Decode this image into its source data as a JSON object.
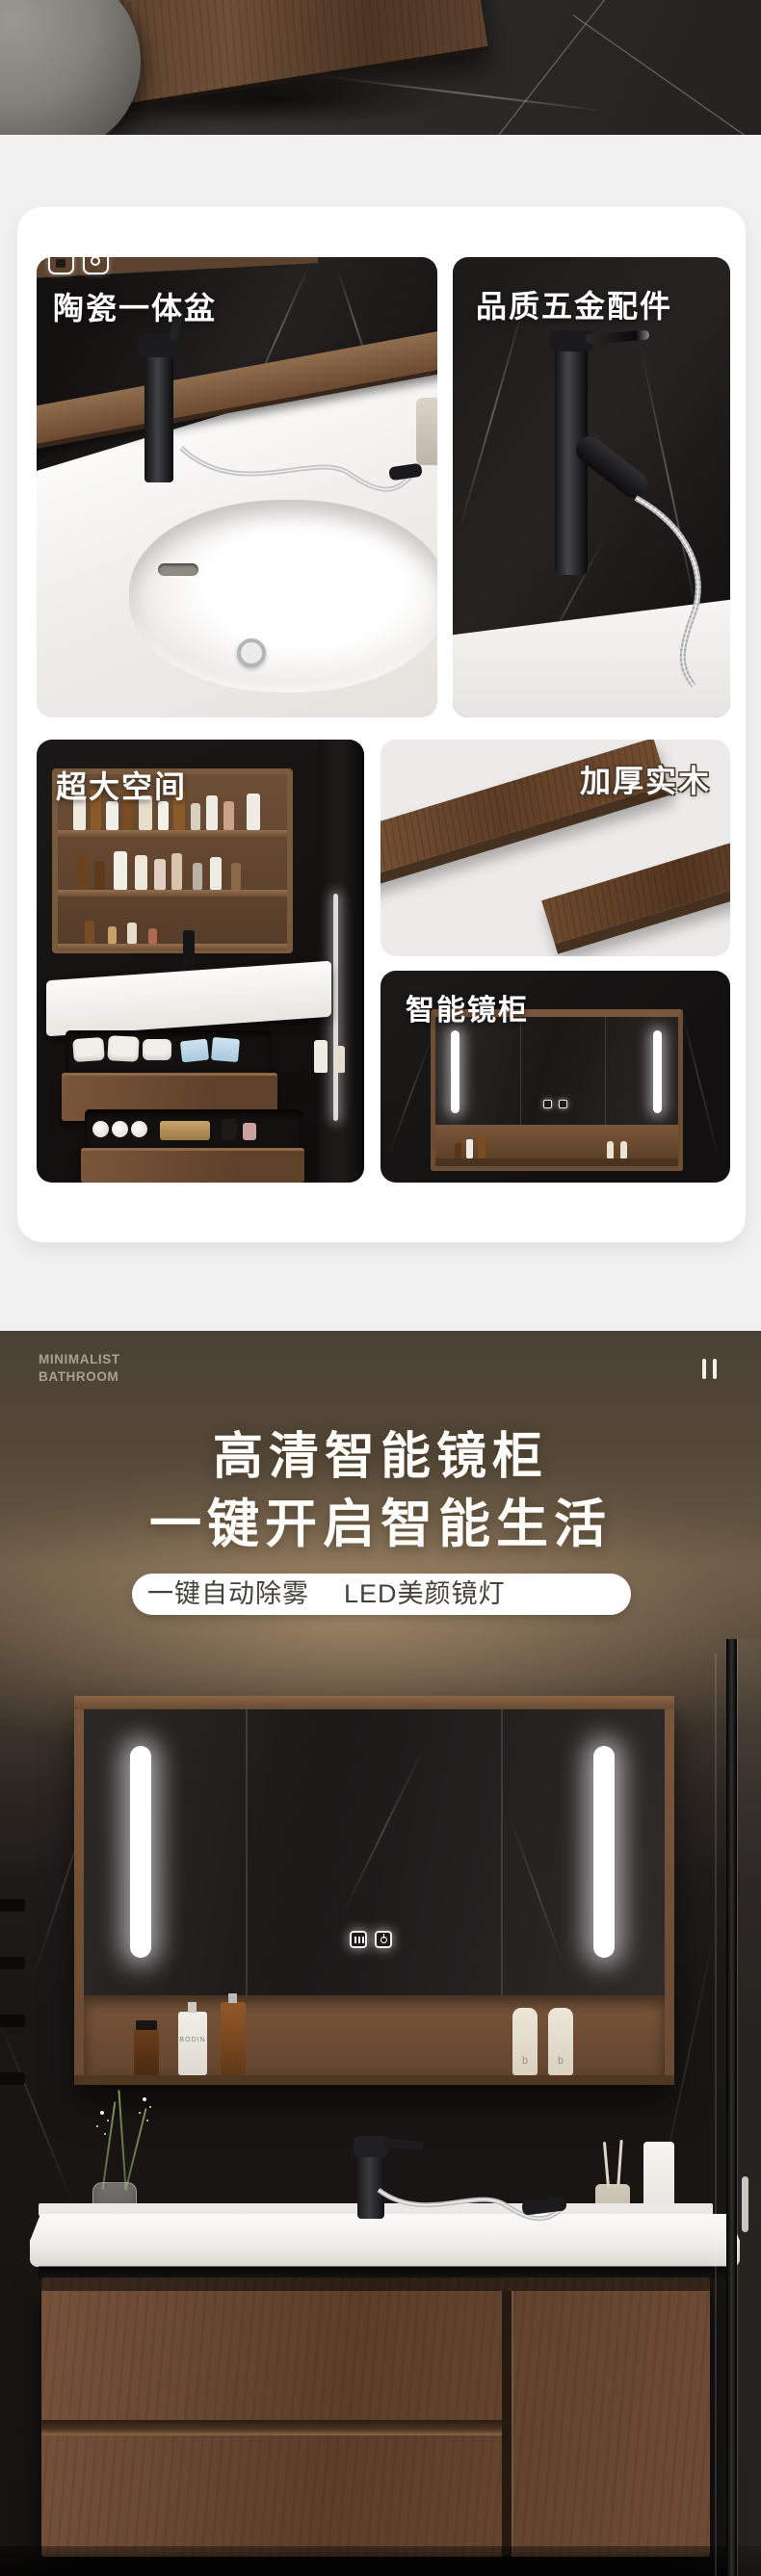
{
  "colors": {
    "page_bg": "#f1f1f2",
    "card_bg": "#ffffff",
    "dark_section_bg": "#4b4235",
    "wood": "#6b4a33",
    "glow": "#cdaf84",
    "led": "#ffffff",
    "hero_text": "#fffdf9",
    "pill_text": "#454038",
    "brand_text": "#a8a096"
  },
  "feature_tiles": [
    {
      "label": "陶瓷一体盆"
    },
    {
      "label": "品质五金配件"
    },
    {
      "label": "超大空间"
    },
    {
      "label": "加厚实木"
    },
    {
      "label": "智能镜柜"
    }
  ],
  "badges": {
    "icons": [
      "lock-badge-icon",
      "camera-badge-icon"
    ]
  },
  "hero": {
    "brand_line1": "MINIMALIST",
    "brand_line2": "BATHROOM",
    "title_line1": "高清智能镜柜",
    "title_line2": "一键开启智能生活",
    "pill_feature1": "一键自动除雾",
    "pill_feature2": "LED美颜镜灯",
    "pause_icon": "pause-icon"
  },
  "scene": {
    "shelf_bottle_label": "BODIN",
    "tube_letter": "b",
    "touch_icons": [
      "defog-touch-icon",
      "power-touch-icon"
    ]
  }
}
